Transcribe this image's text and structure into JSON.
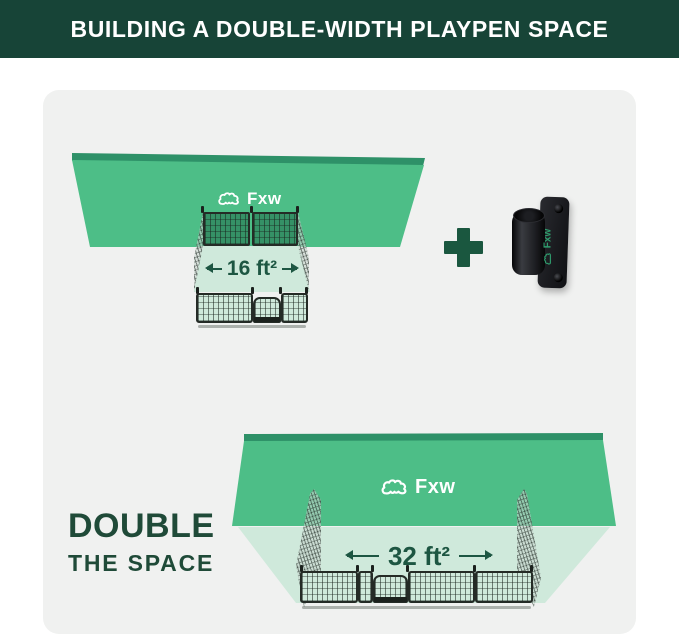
{
  "header": {
    "title": "BUILDING A DOUBLE-WIDTH PLAYPEN SPACE"
  },
  "brand": {
    "name": "Fxw"
  },
  "sections": {
    "single": {
      "area_label": "16 ft²"
    },
    "add_on": {
      "plus_symbol": "+"
    },
    "double": {
      "area_label": "32 ft²",
      "caption_line1": "DOUBLE",
      "caption_line2": "THE SPACE"
    }
  },
  "colors": {
    "header_bg": "#174437",
    "card_bg": "#F0F1F0",
    "wall_green": "#4DBE87",
    "wall_edge_green": "#2E9168",
    "floor_green": "#CFE9DB",
    "label_green": "#1D5642",
    "caption_green": "#1F4A38",
    "plus_green": "#1A573F",
    "fence_frame": "#242B26",
    "bracket_black": "#1A1B1F",
    "brand_logo_green": "#2F9E6E",
    "logo_white": "#FFFFFF"
  }
}
